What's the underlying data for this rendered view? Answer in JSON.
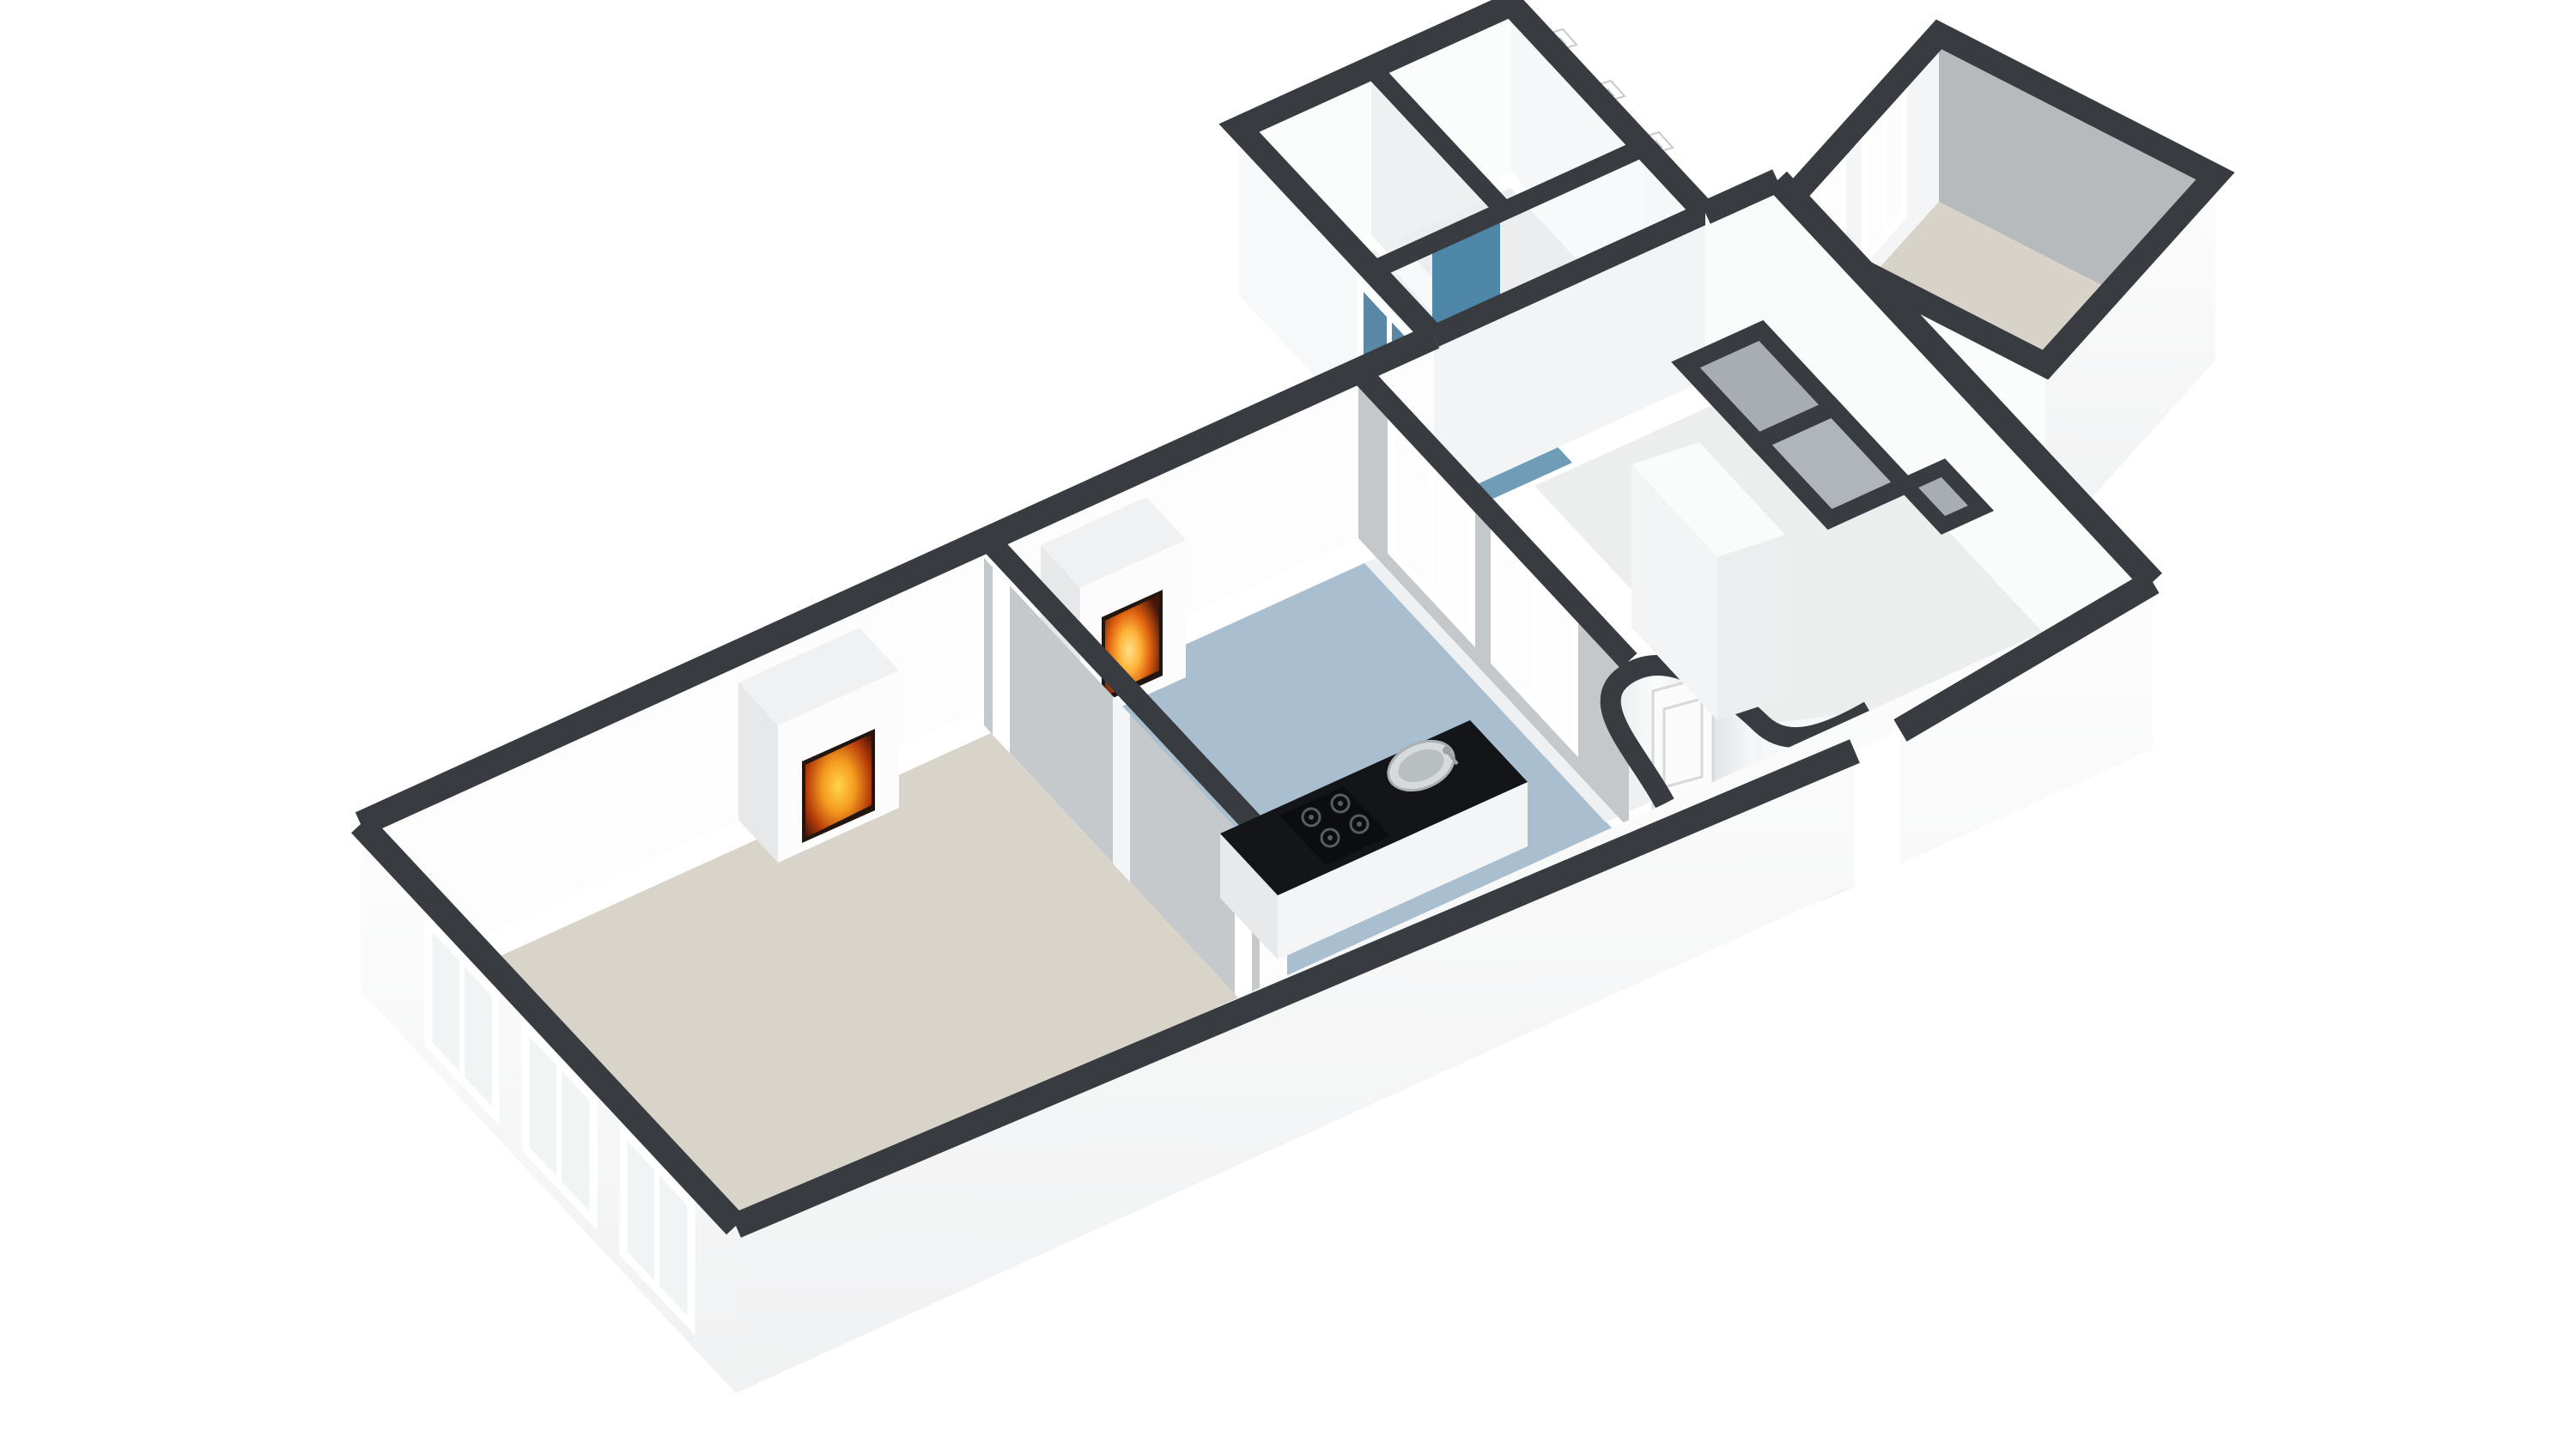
{
  "scene": {
    "kind": "3d-floorplan-dollhouse-view",
    "background_color": "#ffffff",
    "palette": {
      "wall_cap_dark": "#383c40",
      "wall_white": "#fdfdfd",
      "wall_shaded_gray": "#b7babd",
      "wall_mid_gray": "#c6c9cc",
      "floor_living_beige": "#d9d4ca",
      "floor_rear_room_beige": "#d8d3c9",
      "floor_kitchen_blue": "#a9bfd0",
      "floor_corridor_blue_gray": "#c3d1db",
      "floor_bathroom_blue": "#6f9db8",
      "bathroom_wall_blue": "#4e86a7",
      "window_glass_light": "#f1f4f5",
      "window_glass_blue": "#5b87a6",
      "counter_black": "#131518",
      "fire_orange": "#f59b1f",
      "wood_tan": "#c9b394"
    },
    "rooms": [
      {
        "name": "living-room",
        "floor_color": "#d9d4ca",
        "features": [
          "fireplace",
          "three-facade-windows",
          "paneled-partition"
        ]
      },
      {
        "name": "kitchen",
        "floor_color": "#a9bfd0",
        "features": [
          "fireplace",
          "black-island-counter",
          "sink",
          "gas-hob",
          "two-wall-windows",
          "curved-wall-with-door",
          "arched-openings"
        ]
      },
      {
        "name": "corridor",
        "floor_color": "#c3d1db",
        "features": [
          "curved-wall",
          "arched-openings"
        ]
      },
      {
        "name": "hallway",
        "floor_color": "#eceded",
        "features": [
          "storage-closets",
          "tall-wardrobe"
        ]
      },
      {
        "name": "toilet-room",
        "floor_color": "#eef0f1",
        "features": [
          "toilet",
          "hand-basin",
          "mirror"
        ]
      },
      {
        "name": "landing",
        "floor_color": "#ebedee",
        "features": [
          "meter-boxes"
        ]
      },
      {
        "name": "bathroom",
        "floor_color": "#6f9db8",
        "features": [
          "bathtub-with-wood-panel",
          "blue-walls",
          "blue-glass-window"
        ]
      },
      {
        "name": "rear-room",
        "floor_color": "#d8d3c9",
        "features": [
          "two-windows",
          "side-window",
          "white-cabinet"
        ]
      }
    ],
    "counts": {
      "fireplaces": 2,
      "windows_visible": 10,
      "arched-openings": 2,
      "closet-cells": 3,
      "meter-boxes": 3
    }
  }
}
